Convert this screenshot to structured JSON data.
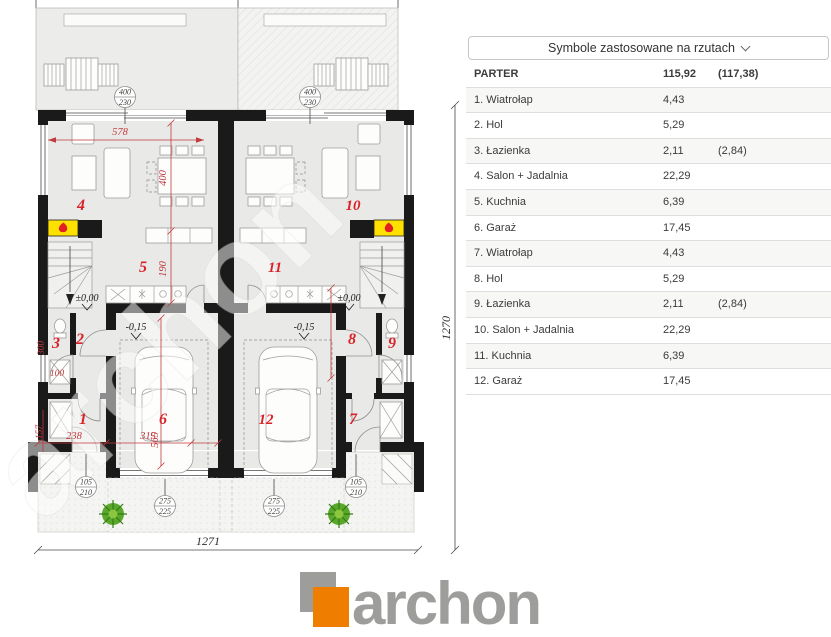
{
  "legend": {
    "title": "Symbole zastosowane na rzutach",
    "total": {
      "name": "PARTER",
      "area": "115,92",
      "area_alt": "(117,38)"
    },
    "rows": [
      {
        "name": "1. Wiatrołap",
        "area": "4,43",
        "area_alt": ""
      },
      {
        "name": "2. Hol",
        "area": "5,29",
        "area_alt": ""
      },
      {
        "name": "3. Łazienka",
        "area": "2,11",
        "area_alt": "(2,84)"
      },
      {
        "name": "4. Salon + Jadalnia",
        "area": "22,29",
        "area_alt": ""
      },
      {
        "name": "5. Kuchnia",
        "area": "6,39",
        "area_alt": ""
      },
      {
        "name": "6. Garaż",
        "area": "17,45",
        "area_alt": ""
      },
      {
        "name": "7. Wiatrołap",
        "area": "4,43",
        "area_alt": ""
      },
      {
        "name": "8. Hol",
        "area": "5,29",
        "area_alt": ""
      },
      {
        "name": "9. Łazienka",
        "area": "2,11",
        "area_alt": "(2,84)"
      },
      {
        "name": "10. Salon + Jadalnia",
        "area": "22,29",
        "area_alt": ""
      },
      {
        "name": "11. Kuchnia",
        "area": "6,39",
        "area_alt": ""
      },
      {
        "name": "12. Garaż",
        "area": "17,45",
        "area_alt": ""
      }
    ]
  },
  "plan": {
    "rooms": {
      "n1": "1",
      "n2": "2",
      "n3": "3",
      "n4": "4",
      "n5": "5",
      "n6": "6",
      "n7": "7",
      "n8": "8",
      "n9": "9",
      "n10": "10",
      "n11": "11",
      "n12": "12"
    },
    "dims": {
      "total_w": "1271",
      "total_h": "1270",
      "salon_w": "578",
      "salon_d": "400",
      "kitchen_d": "190",
      "bath_d": "300",
      "bath_w": "100",
      "entry_d": "157",
      "entry_w": "238",
      "garage_w": "315",
      "garage_d": "565"
    },
    "levels": {
      "zero": "±0,00",
      "garage": "-0,15"
    },
    "bubbles": {
      "terrace_w": "400",
      "terrace_h": "230",
      "entry_w": "105",
      "entry_h": "210",
      "garage_w": "275",
      "garage_h": "225"
    },
    "watermark": "archon"
  },
  "logo": {
    "text": "archon"
  },
  "colors": {
    "accent_orange": "#ee7d00",
    "room_red": "#d8232a",
    "dim_red": "#c13a3e",
    "wall_black": "#1a1a1a",
    "fireplace_yellow": "#ffe100"
  }
}
